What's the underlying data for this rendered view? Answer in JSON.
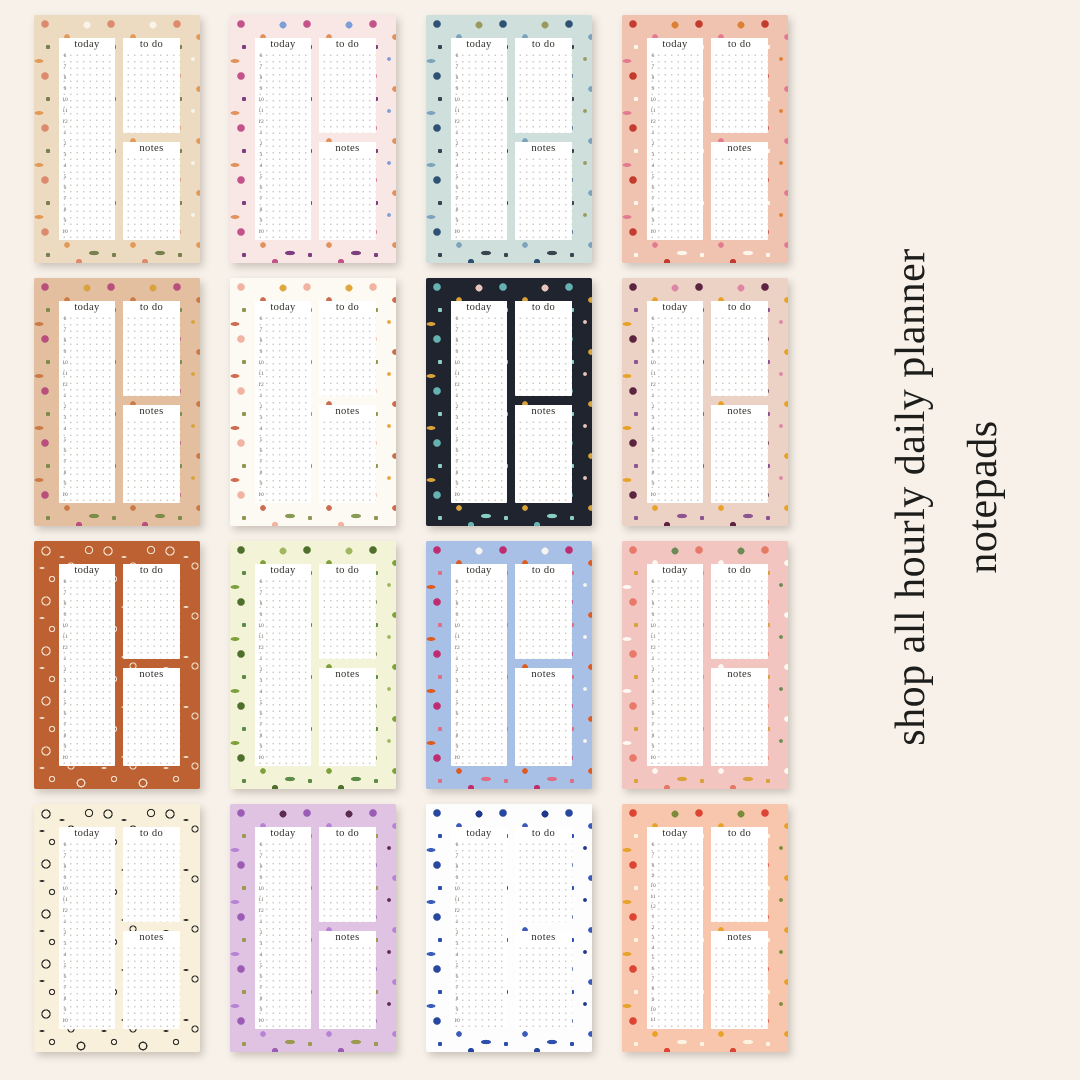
{
  "page": {
    "background": "#f7f1ea"
  },
  "caption": {
    "line1": "shop all hourly daily planner",
    "line2": "notepads",
    "color": "#1d1d1b"
  },
  "pad_template": {
    "today_label": "today",
    "todo_label": "to do",
    "notes_label": "notes",
    "hours": [
      "6",
      "7",
      "8",
      "9",
      "10",
      "11",
      "12",
      "1",
      "2",
      "3",
      "4",
      "5",
      "6",
      "7",
      "8",
      "9",
      "10"
    ],
    "hours_late": [
      "6",
      "7",
      "8",
      "9",
      "10",
      "11",
      "12",
      "1",
      "2",
      "3",
      "4",
      "5",
      "6",
      "7",
      "8",
      "9",
      "10",
      "11"
    ]
  },
  "pads": [
    {
      "name": "peach-meadow-floral",
      "bg": "#ecdbc1",
      "colors": [
        "#dd8a6e",
        "#e39a58",
        "#f9f4e9",
        "#77804e"
      ],
      "pattern": "solid"
    },
    {
      "name": "berry-wildflower",
      "bg": "#f8e7e4",
      "colors": [
        "#c4538a",
        "#e2925c",
        "#7d9ed8",
        "#7d3f80"
      ],
      "pattern": "solid"
    },
    {
      "name": "dusty-blue-floral",
      "bg": "#cfe0dc",
      "colors": [
        "#2e5273",
        "#7da3bd",
        "#9a9a60",
        "#3a434e"
      ],
      "pattern": "solid"
    },
    {
      "name": "bold-red-poppy",
      "bg": "#f0c3b1",
      "colors": [
        "#c43b2d",
        "#e27a90",
        "#dd8033",
        "#fdf6ec"
      ],
      "pattern": "solid"
    },
    {
      "name": "magenta-garden",
      "bg": "#e3bfa0",
      "colors": [
        "#b84f7d",
        "#cc7a47",
        "#d9a23f",
        "#7d8c4a"
      ],
      "pattern": "solid"
    },
    {
      "name": "soft-rose",
      "bg": "#fcfaf2",
      "colors": [
        "#f2b3a3",
        "#cc6d52",
        "#e2a83f",
        "#8a9a55"
      ],
      "pattern": "solid"
    },
    {
      "name": "midnight-teal-floral",
      "bg": "#20242e",
      "colors": [
        "#66b2b2",
        "#d9a23b",
        "#e8c4ba",
        "#8accc6"
      ],
      "pattern": "solid"
    },
    {
      "name": "retro-plum-sunflower",
      "bg": "#ecd2c4",
      "colors": [
        "#5c2440",
        "#e8a227",
        "#dd87a5",
        "#8c5490"
      ],
      "pattern": "solid"
    },
    {
      "name": "terracotta-line-floral",
      "bg": "#bd6133",
      "colors": [
        "#f0ddca"
      ],
      "pattern": "rings"
    },
    {
      "name": "green-botanical-leaves",
      "bg": "#f3f3d8",
      "colors": [
        "#4f702d",
        "#7da23b",
        "#a2b860",
        "#5c8c47"
      ],
      "pattern": "solid"
    },
    {
      "name": "bright-summer-garden",
      "bg": "#a9c0e6",
      "colors": [
        "#bd2d70",
        "#dd5c24",
        "#f7f3ee",
        "#e06d88"
      ],
      "pattern": "solid"
    },
    {
      "name": "pink-daisy-meadow",
      "bg": "#f2c5c1",
      "colors": [
        "#e57a66",
        "#fdf8f2",
        "#6d8c55",
        "#dba23b"
      ],
      "pattern": "solid"
    },
    {
      "name": "ink-sketch-botanical",
      "bg": "#f8f0da",
      "colors": [
        "#2e2e2e"
      ],
      "pattern": "rings"
    },
    {
      "name": "lavender-watercolor",
      "bg": "#e0c2e2",
      "colors": [
        "#9a5cb5",
        "#b584d6",
        "#5c2d4f",
        "#9a9a50"
      ],
      "pattern": "solid"
    },
    {
      "name": "navy-block-print",
      "bg": "#fdfdfd",
      "colors": [
        "#2847a0",
        "#3b5cb8",
        "#1f3a8c",
        "#2f4fae"
      ],
      "pattern": "solid"
    },
    {
      "name": "strawberry-patch",
      "bg": "#f7c6ac",
      "colors": [
        "#dd4433",
        "#e8a227",
        "#7d8c3b",
        "#fdf3e3"
      ],
      "pattern": "solid",
      "hours_key": "hours_late"
    }
  ]
}
